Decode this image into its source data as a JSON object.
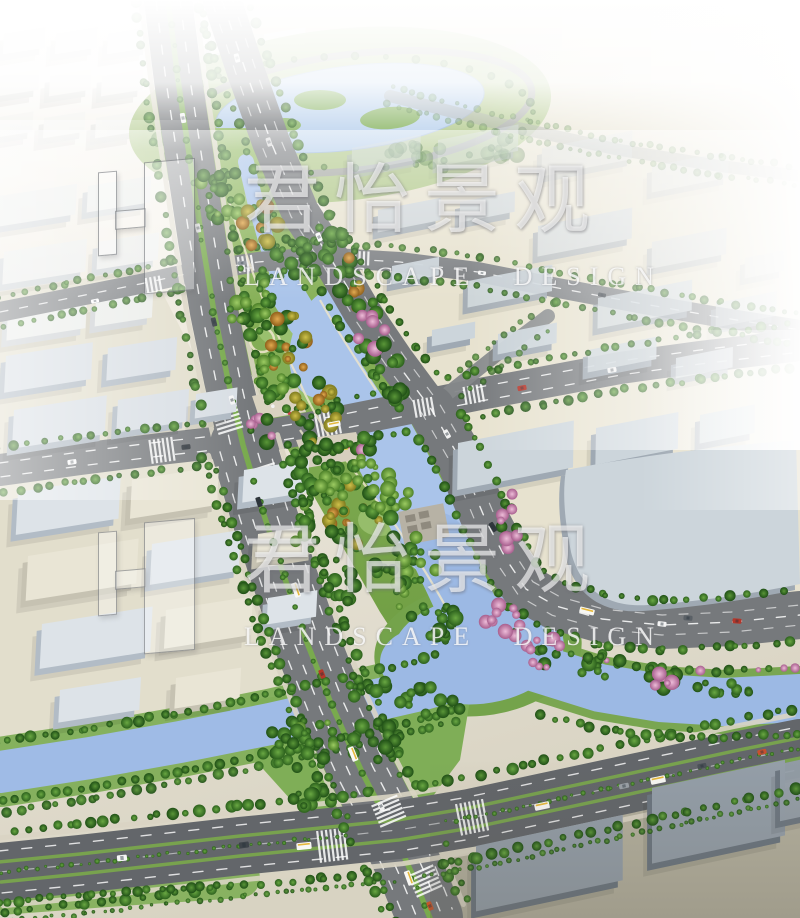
{
  "watermark": {
    "brand_cn": "君怡景观",
    "brand_en": "LANDSCAPE DESIGN"
  },
  "scene": {
    "subject": "Aerial perspective rendering of a riverside greenway landscape design",
    "elements": [
      "lake park with loop road and islands",
      "winding river corridor with dense trees and flowering accents",
      "tree-lined dual-carriageway boulevards",
      "signalized intersections with zebra crossings and buses",
      "low industrial building blocks fading into haze",
      "canal with double tree rows"
    ]
  },
  "colors": {
    "haze": "#ffffff",
    "ground": "#e7e2cf",
    "ground_west": "#e2decc",
    "ground_dark": "#b4b09e",
    "road": "#76797c",
    "road_light": "#7e8184",
    "road_dark": "#63666a",
    "lane_marking": "#ffffff",
    "pavement_edge": "#d9d4c3",
    "median_green": "#79aa4e",
    "park_green": "#7fae57",
    "park_green_deep": "#6d9c41",
    "water": "#aac4ea",
    "water_deep": "#9cb9e4",
    "building_top": "#ccd5db",
    "building_side": "#9fa9b3",
    "building_dark_top": "#949ea8",
    "building_dark_side": "#6b757f",
    "building_faded_top": "#f3f3ef",
    "building_faded_side": "#dcddd9",
    "terrace": "#b7b2a5",
    "bus_stripe": "#e6b83c"
  }
}
